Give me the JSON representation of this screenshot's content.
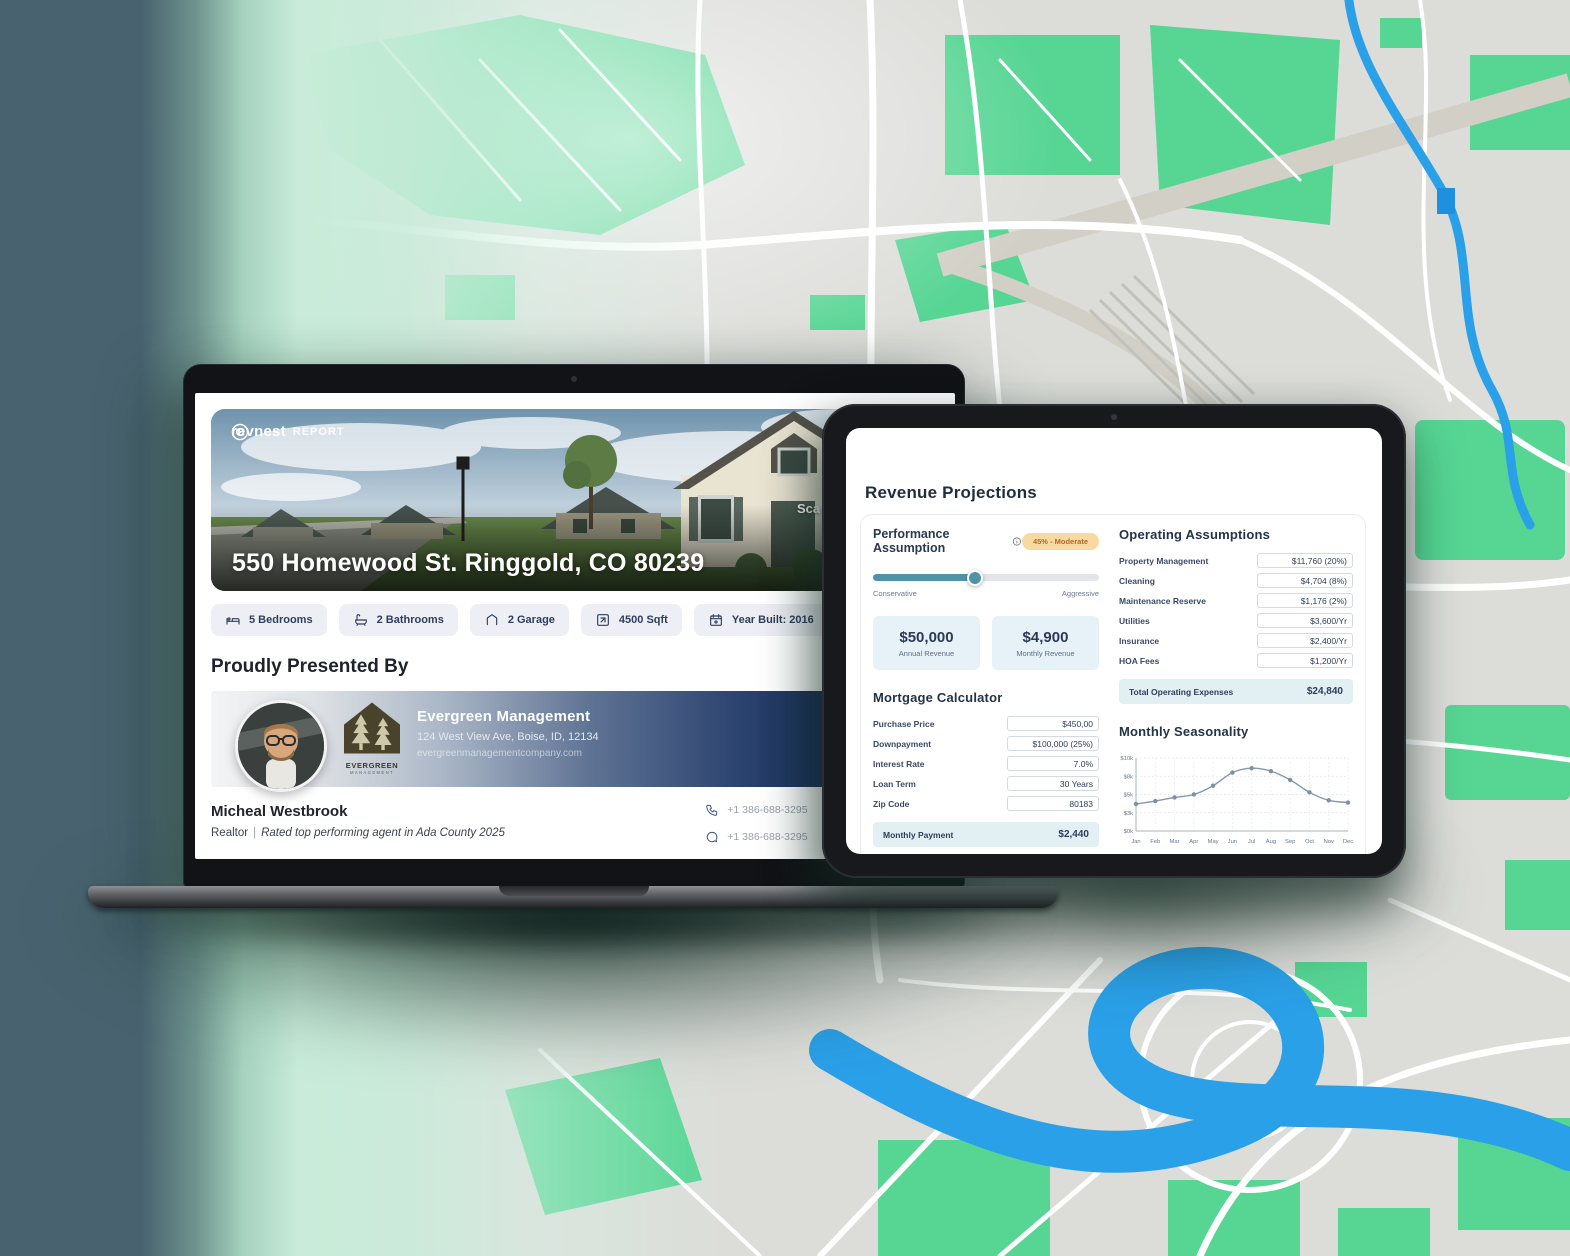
{
  "colors": {
    "map_base": "#dcddd9",
    "map_green": "#56d593",
    "map_road": "#ffffff",
    "map_water": "#2aa0e8",
    "accent_teal": "#4f93a8",
    "navy": "#2e3f5e",
    "assumption_badge_bg": "#f7d9a2",
    "assumption_badge_text": "#b4682b",
    "highlight_row_bg": "#e2f0f4"
  },
  "laptop": {
    "logo": {
      "brand": "revnest",
      "suffix": "REPORT"
    },
    "hero": {
      "address": "550 Homewood St. Ringgold, CO 80239",
      "scan_text": "Sca"
    },
    "badges": [
      {
        "icon": "bed-icon",
        "label": "5 Bedrooms"
      },
      {
        "icon": "bathtub-icon",
        "label": "2 Bathrooms"
      },
      {
        "icon": "garage-icon",
        "label": "2 Garage"
      },
      {
        "icon": "area-icon",
        "label": "4500 Sqft"
      },
      {
        "icon": "calendar-icon",
        "label": "Year Built: 2016"
      }
    ],
    "presented": {
      "heading": "Proudly Presented By",
      "company": "Evergreen Management",
      "address": "124 West View Ave, Boise, ID, 12134",
      "website": "evergreenmanagementcompany.com",
      "logo_line1": "EVERGREEN",
      "logo_line2": "MANAGEMENT"
    },
    "realtor": {
      "name": "Micheal Westbrook",
      "role": "Realtor",
      "separator": "|",
      "tagline": "Rated top performing agent in Ada County 2025",
      "phone": "+1 386-688-3295",
      "sms": "+1 386-688-3295",
      "email": "hello@example.",
      "brokerage": "RevNest Estate"
    }
  },
  "tablet": {
    "title": "Revenue Projections",
    "performance": {
      "label": "Performance Assumption",
      "badge": "45% - Moderate",
      "slider_percent": 45,
      "min_label": "Conservative",
      "max_label": "Aggressive"
    },
    "revenue_cards": [
      {
        "value": "$50,000",
        "label": "Annual Revenue"
      },
      {
        "value": "$4,900",
        "label": "Monthly Revenue"
      }
    ],
    "operating": {
      "title": "Operating Assumptions",
      "rows": [
        {
          "label": "Property Management",
          "value": "$11,760 (20%)"
        },
        {
          "label": "Cleaning",
          "value": "$4,704 (8%)"
        },
        {
          "label": "Maintenance Reserve",
          "value": "$1,176 (2%)"
        },
        {
          "label": "Utilities",
          "value": "$3,600/Yr"
        },
        {
          "label": "Insurance",
          "value": "$2,400/Yr"
        },
        {
          "label": "HOA Fees",
          "value": "$1,200/Yr"
        }
      ],
      "total_label": "Total Operating Expenses",
      "total_value": "$24,840"
    },
    "mortgage": {
      "title": "Mortgage Calculator",
      "rows": [
        {
          "label": "Purchase Price",
          "value": "$450,00"
        },
        {
          "label": "Downpayment",
          "value": "$100,000 (25%)"
        },
        {
          "label": "Interest Rate",
          "value": "7.0%"
        },
        {
          "label": "Loan Term",
          "value": "30 Years"
        },
        {
          "label": "Zip Code",
          "value": "80183"
        }
      ],
      "total_label": "Monthly Payment",
      "total_value": "$2,440"
    },
    "seasonality_title": "Monthly Seasonality"
  },
  "chart_data": {
    "type": "line",
    "title": "Monthly Seasonality",
    "x": [
      "Jan",
      "Feb",
      "Mar",
      "Apr",
      "May",
      "Jun",
      "Jul",
      "Aug",
      "Sep",
      "Oct",
      "Nov",
      "Dec"
    ],
    "values": [
      3700,
      4100,
      4600,
      5000,
      6200,
      8000,
      8600,
      8200,
      7000,
      5300,
      4200,
      3900
    ],
    "ylim": [
      0,
      10000
    ],
    "ytick_values": [
      0,
      2500,
      5000,
      7500,
      10000
    ],
    "ytick_labels": [
      "$0k",
      "$3k",
      "$5k",
      "$8k",
      "$10k"
    ],
    "xlabel": "",
    "ylabel": "",
    "grid": true,
    "legend": false,
    "line_color": "#8496ae"
  }
}
